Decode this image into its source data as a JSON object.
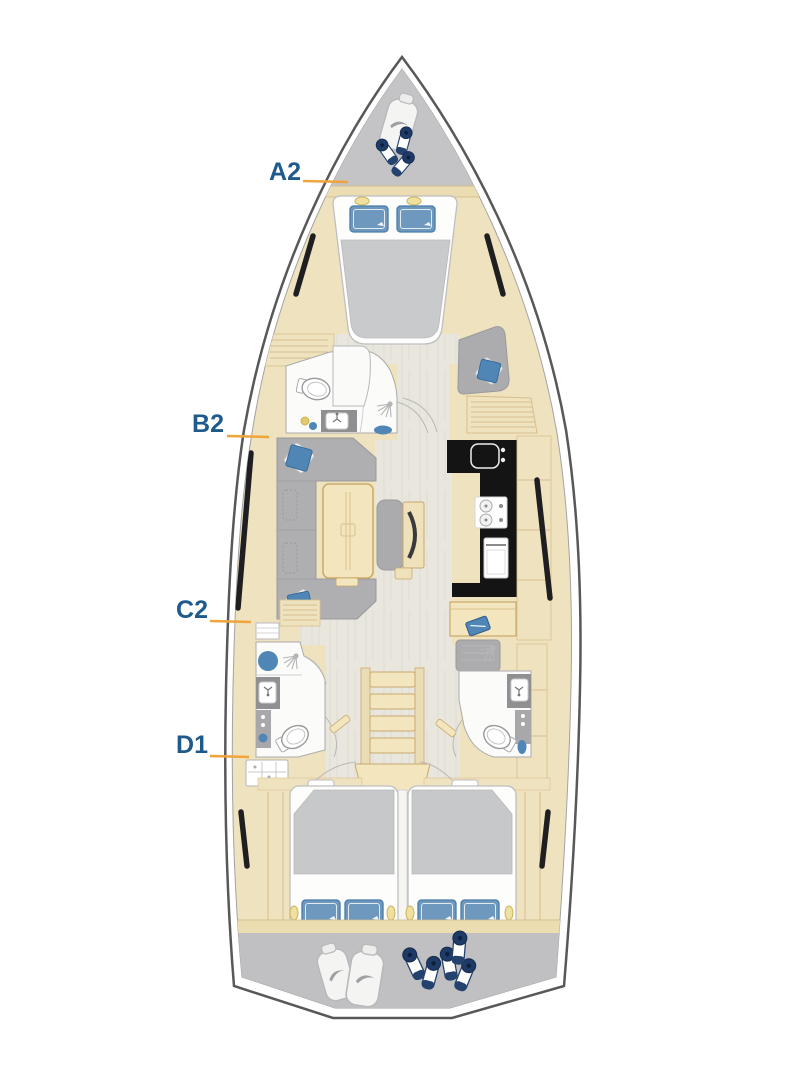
{
  "plan": {
    "type": "sailing-yacht-interior-deck-plan-top-view",
    "labels": [
      {
        "id": "a2",
        "text": "A2"
      },
      {
        "id": "b2",
        "text": "B2"
      },
      {
        "id": "c2",
        "text": "C2"
      },
      {
        "id": "d1",
        "text": "D1"
      }
    ],
    "colors": {
      "label_text": "#1E5A8C",
      "callout_line": "#F0A43C",
      "hull_outline": "#58585A",
      "deck_gray": "#C4C4C6",
      "wood_tan": "#F0E2BE",
      "floor_light": "#E9E6DE",
      "furniture_gray": "#AFAFB1",
      "cushion_blue": "#4F86B6",
      "pillow_blue": "#6E98BD",
      "fender_navy": "#1E3A66",
      "galley_black": "#141414"
    },
    "icons": [
      "sail-bag-icon",
      "fender-icon",
      "shower-head-icon",
      "toilet-icon",
      "sink-icon",
      "faucet-icon",
      "stove-icon",
      "oven-icon",
      "reading-light-icon",
      "pillow-icon",
      "notebook-icon",
      "hull-window"
    ]
  }
}
